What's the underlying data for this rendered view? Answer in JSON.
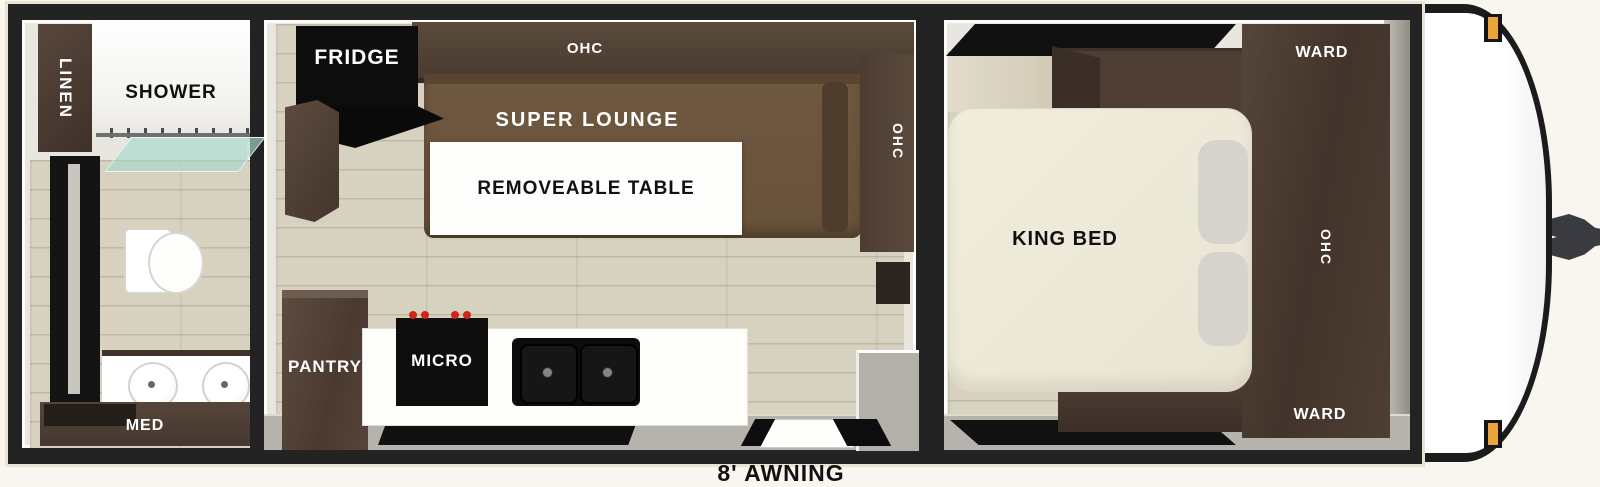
{
  "exterior": {
    "awning_label": "8' AWNING"
  },
  "bathroom": {
    "linen": "LINEN",
    "shower": "SHOWER",
    "med": "MED"
  },
  "living": {
    "fridge": "FRIDGE",
    "ohc_top": "OHC",
    "super_lounge": "SUPER LOUNGE",
    "removeable_table": "REMOVEABLE TABLE",
    "ohc_side": "OHC",
    "pantry": "PANTRY",
    "micro": "MICRO"
  },
  "bedroom": {
    "ward_top": "WARD",
    "ohc": "OHC",
    "ward_bottom": "WARD",
    "king_bed": "KING BED"
  },
  "colors": {
    "wall": "#232323",
    "cabinet_dark": "#4c3d33",
    "lounge_brown": "#6e573e",
    "bed_cream": "#efecdc",
    "floor_tan": "#d7d2c0",
    "marker_amber": "#e9a43c",
    "label_white": "#ffffff",
    "label_black": "#111111"
  }
}
